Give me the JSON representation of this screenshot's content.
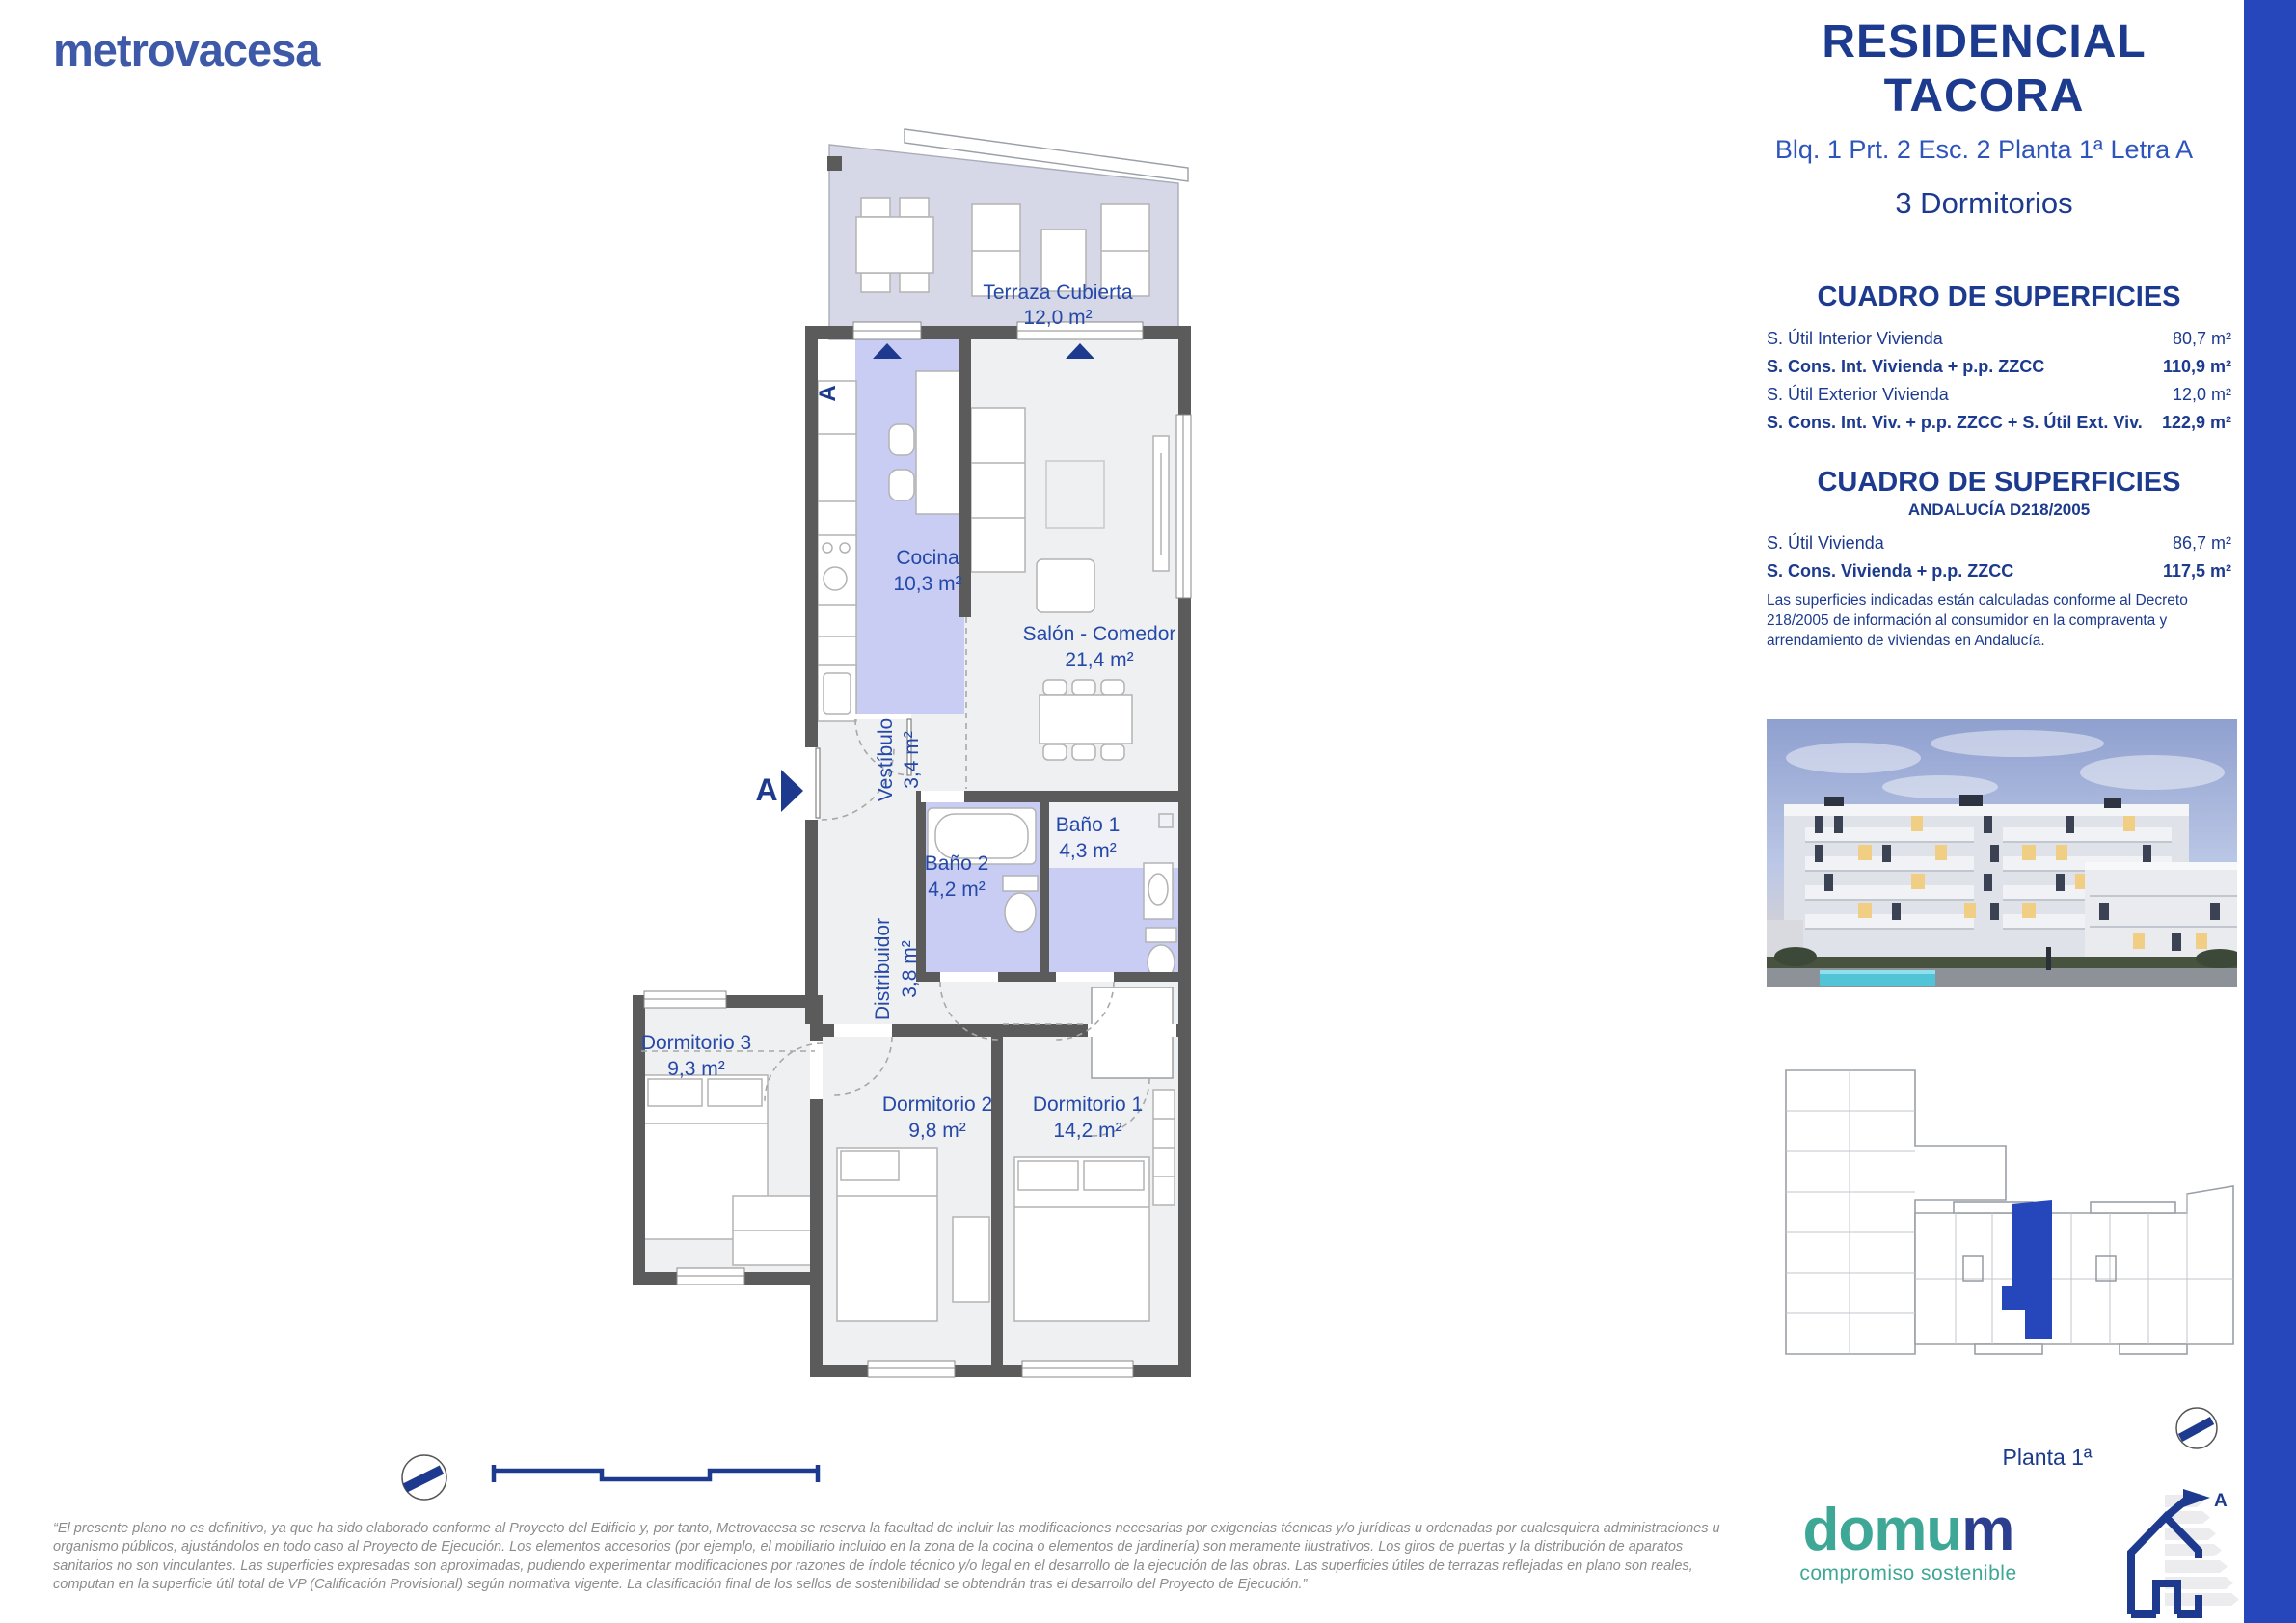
{
  "page": {
    "accent_bar_color": "#2547BB",
    "background": "#FFFFFF"
  },
  "header": {
    "logo_text": "metrovacesa",
    "project_title_line1": "RESIDENCIAL",
    "project_title_line2": "TACORA",
    "unit_subtitle": "Blq. 1 Prt. 2 Esc. 2 Planta 1ª Letra A",
    "bedrooms_label": "3 Dormitorios"
  },
  "surfaces_table": {
    "title": "CUADRO DE SUPERFICIES",
    "rows": [
      {
        "label": "S. Útil Interior Vivienda",
        "value": "80,7 m²"
      },
      {
        "label": "S. Cons. Int. Vivienda + p.p. ZZCC",
        "value": "110,9 m²"
      },
      {
        "label": "S. Útil Exterior Vivienda",
        "value": "12,0 m²"
      },
      {
        "label": "S. Cons. Int. Viv. + p.p. ZZCC + S. Útil Ext. Viv.",
        "value": "122,9 m²"
      }
    ]
  },
  "surfaces_table_andalucia": {
    "title": "CUADRO DE SUPERFICIES",
    "subtitle": "ANDALUCÍA D218/2005",
    "rows": [
      {
        "label": "S. Útil Vivienda",
        "value": "86,7 m²"
      },
      {
        "label": "S. Cons. Vivienda + p.p. ZZCC",
        "value": "117,5 m²"
      }
    ],
    "note": "Las superficies indicadas están calculadas conforme al Decreto 218/2005 de información al consumidor en la compraventa y arrendamiento de viviendas en Andalucía."
  },
  "plan": {
    "section_marker": "A",
    "rooms": [
      {
        "name": "Terraza Cubierta",
        "area": "12,0 m²"
      },
      {
        "name": "Cocina",
        "area": "10,3 m²"
      },
      {
        "name": "Salón - Comedor",
        "area": "21,4 m²"
      },
      {
        "name": "Vestíbulo",
        "area": "3,4 m²"
      },
      {
        "name": "Baño 1",
        "area": "4,3 m²"
      },
      {
        "name": "Baño 2",
        "area": "4,2 m²"
      },
      {
        "name": "Distribuidor",
        "area": "3,8 m²"
      },
      {
        "name": "Dormitorio 3",
        "area": "9,3 m²"
      },
      {
        "name": "Dormitorio 2",
        "area": "9,8 m²"
      },
      {
        "name": "Dormitorio 1",
        "area": "14,2 m²"
      }
    ],
    "colors": {
      "wall": "#5B5B5B",
      "room_fill": "#EFF0F2",
      "wet_room_fill": "#C9CDF3",
      "terrace_fill": "#D6D8E7",
      "label_blue": "#2549A8"
    }
  },
  "floor_caption": "Planta 1ª",
  "branding": {
    "domum_part1": "domu",
    "domum_part2": "m",
    "domum_tagline": "compromiso sostenible",
    "energy_rating_letter": "A"
  },
  "disclaimer": "“El presente plano no es definitivo, ya que ha sido elaborado conforme al Proyecto del Edificio y, por tanto, Metrovacesa se reserva la facultad de incluir las modificaciones necesarias por exigencias técnicas y/o jurídicas u ordenadas por cualesquiera administraciones u organismo públicos, ajustándolos en todo caso al Proyecto de Ejecución. Los elementos accesorios (por ejemplo, el mobiliario incluido en la zona de la cocina o elementos de jardinería) son meramente ilustrativos. Los giros de puertas y la distribución de aparatos sanitarios no son vinculantes. Las superficies expresadas son aproximadas, pudiendo experimentar modificaciones por razones de índole técnico y/o legal en el desarrollo de la ejecución de las obras. Las superficies útiles de terrazas reflejadas en plano son reales, computan en la superficie útil total de VP (Calificación Provisional) según normativa vigente. La clasificación final de los sellos de sostenibilidad se obtendrán tras el desarrollo del Proyecto de Ejecución.”"
}
